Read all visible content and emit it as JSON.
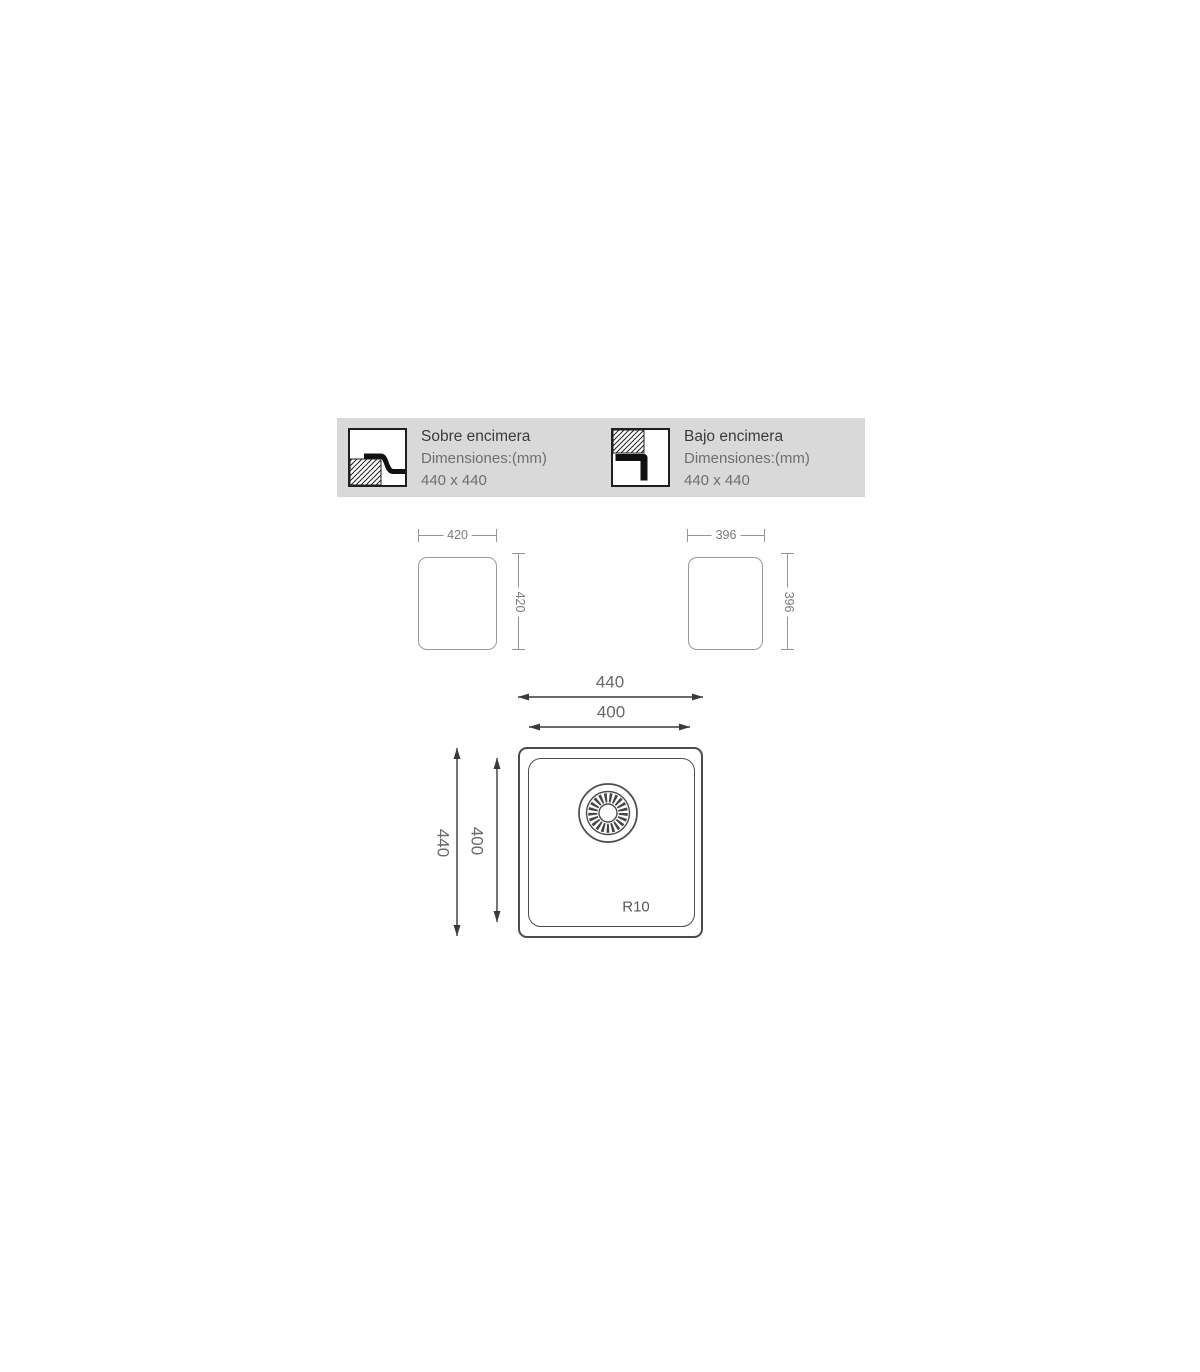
{
  "diagram": {
    "header": {
      "options": [
        {
          "icon": "topmount-profile-icon",
          "title": "Sobre encimera",
          "dimensions_label": "Dimensiones:(mm)",
          "size": "440 x 440"
        },
        {
          "icon": "undermount-profile-icon",
          "title": "Bajo encimera",
          "dimensions_label": "Dimensiones:(mm)",
          "size": "440 x 440"
        }
      ]
    },
    "cutouts": [
      {
        "name": "topmount-cutout",
        "width_mm": "420",
        "height_mm": "420"
      },
      {
        "name": "undermount-cutout",
        "width_mm": "396",
        "height_mm": "396"
      }
    ],
    "sink": {
      "outer_width_mm": "440",
      "inner_width_mm": "400",
      "outer_height_mm": "440",
      "inner_height_mm": "400",
      "corner_radius": "R10"
    },
    "colors": {
      "header_bg": "#d9d9d9",
      "title_text": "#3b3b3b",
      "secondary_text": "#6e6e6e",
      "drawing_line": "#4c4c4c",
      "dimension_line": "#949494",
      "dimension_text": "#7a7a7a"
    }
  }
}
